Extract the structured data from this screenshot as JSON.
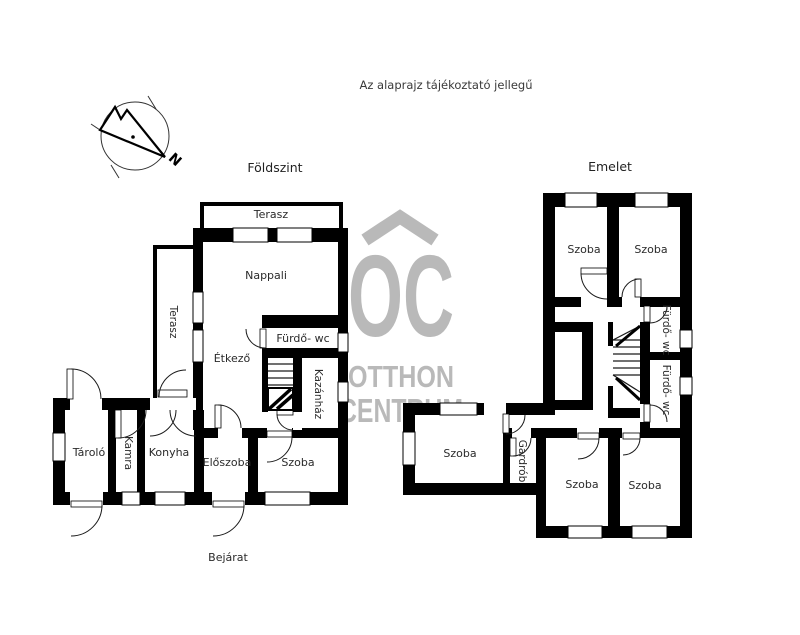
{
  "page": {
    "disclaimer": "Az alaprajz tájékoztató jellegű"
  },
  "compass": {
    "north_label": "N"
  },
  "watermark": {
    "monogram": "OC",
    "line1": "OTTHON",
    "line2": "CENTRUM",
    "color": "#b9b9b9"
  },
  "ground_floor": {
    "title": "Földszint",
    "entrance_label": "Bejárat",
    "rooms": {
      "terasz_top": "Terasz",
      "nappali": "Nappali",
      "terasz_side": "Terasz",
      "furdo_wc": "Fürdő- wc",
      "etkezo": "Étkező",
      "kazanhaz": "Kazánház",
      "tarolo": "Tároló",
      "kamra": "Kamra",
      "konyha": "Konyha",
      "eloszoba": "Előszoba",
      "szoba": "Szoba"
    }
  },
  "upper_floor": {
    "title": "Emelet",
    "rooms": {
      "szoba_top_left": "Szoba",
      "szoba_top_right": "Szoba",
      "furdo_wc_1": "Fürdő- wc",
      "furdo_wc_2": "Fürdő- wc",
      "szoba_wing": "Szoba",
      "gardrob": "Gardrób",
      "szoba_bottom_mid": "Szoba",
      "szoba_bottom_right": "Szoba"
    }
  },
  "colors": {
    "wall": "#000000",
    "watermark_gray": "#b9b9b9"
  }
}
